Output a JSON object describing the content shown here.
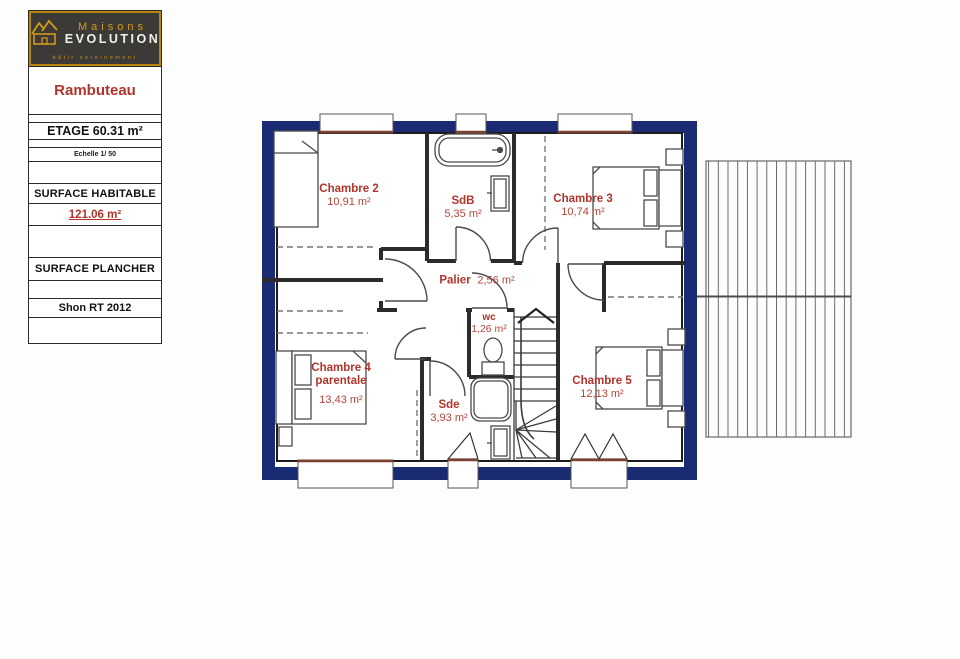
{
  "sidebar": {
    "logo": {
      "brand_top": "Maisons",
      "brand_bottom": "EVOLUTION",
      "tagline": "bâtir sereinement"
    },
    "project_name": "Rambuteau",
    "floor_label": "ETAGE 60.31 m²",
    "scale_label": "Echelle 1/ 50",
    "surface_habitable_label": "SURFACE HABITABLE",
    "surface_habitable_value": "121.06 m²",
    "surface_plancher_label": "SURFACE PLANCHER",
    "shon_label": "Shon RT 2012"
  },
  "plan": {
    "rooms": [
      {
        "name": "Chambre 2",
        "area": "10,91 m²"
      },
      {
        "name": "SdB",
        "area": "5,35 m²"
      },
      {
        "name": "Chambre 3",
        "area": "10,74 m²"
      },
      {
        "name": "Palier",
        "area": "2,56 m²"
      },
      {
        "name": "wc",
        "area": "1,26 m²"
      },
      {
        "name": "Chambre 4",
        "name2": "parentale",
        "area": "13,43 m²"
      },
      {
        "name": "Sde",
        "area": "3,93 m²"
      },
      {
        "name": "Chambre 5",
        "area": "12,13 m²"
      }
    ]
  },
  "colors": {
    "wall_navy": "#1a2a73",
    "label_red": "#b0342c",
    "sill_brown": "#7d4031",
    "logo_gold": "#d09a1e"
  }
}
